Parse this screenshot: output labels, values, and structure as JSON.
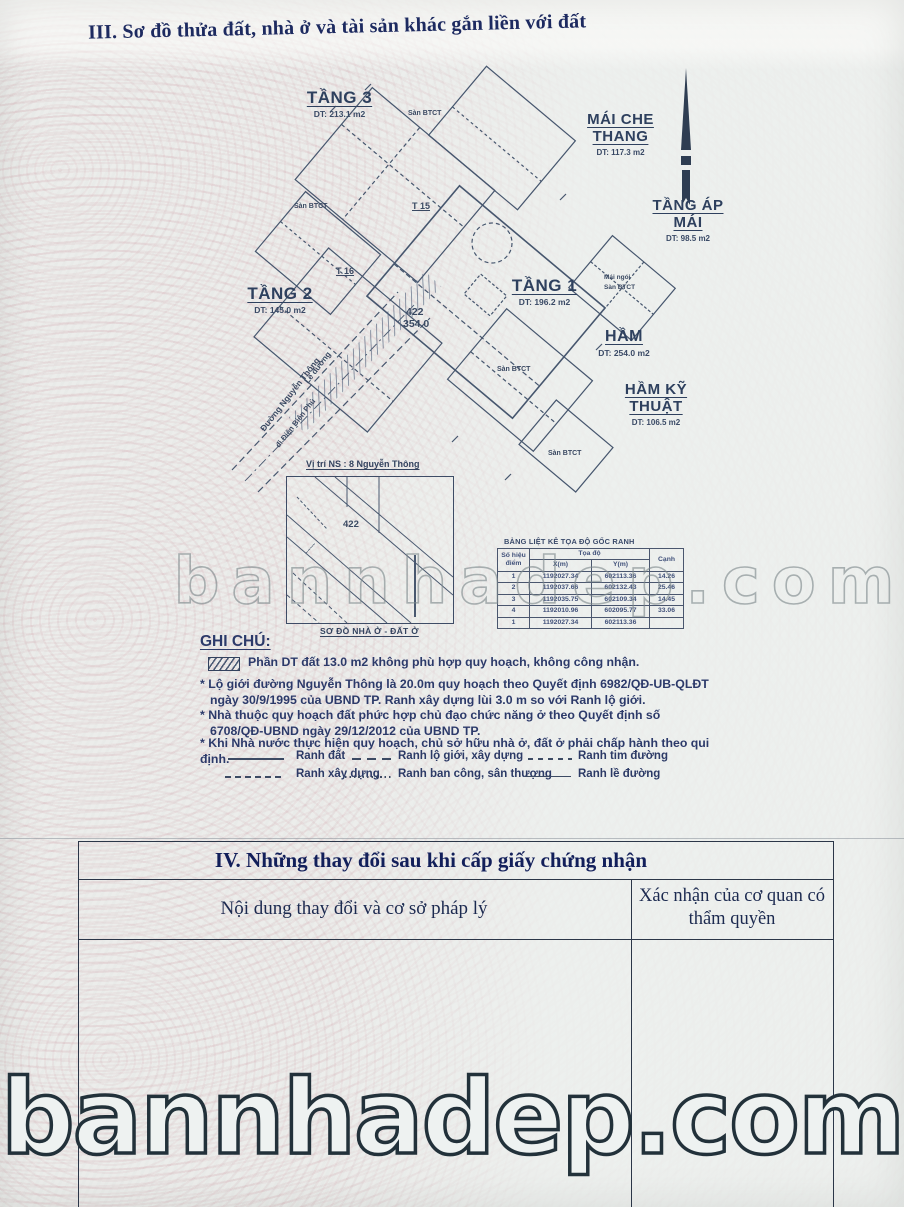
{
  "page": {
    "section3_title": "III. Sơ đồ thửa đất, nhà ở và tài sản khác gắn liền với đất",
    "watermark_middle": "bannhadep.com",
    "watermark_bottom": "bannhadep.com"
  },
  "plan": {
    "floors": [
      {
        "name": "TẦNG 3",
        "area": "DT: 213.1 m2"
      },
      {
        "name": "MÁI CHE THANG",
        "area": "DT: 117.3 m2"
      },
      {
        "name": "TẦNG ÁP MÁI",
        "area": "DT: 98.5 m2"
      },
      {
        "name": "TẦNG 2",
        "area": "DT: 145.0 m2"
      },
      {
        "name": "TẦNG 1",
        "area": "DT: 196.2 m2"
      },
      {
        "name": "HẦM",
        "area": "DT: 254.0 m2"
      },
      {
        "name": "HẦM KỸ THUẬT",
        "area": "DT: 106.5 m2"
      }
    ],
    "annotations": {
      "san_btct": "Sàn BTCT",
      "mai_ngoi": "Mái ngói",
      "t15": "T 15",
      "t16": "T 16",
      "parcel_number": "422",
      "parcel_area": "354.0",
      "le_duong": "Lề đường",
      "street_name": "Đường Nguyễn Thông",
      "street_direction": "đi Điện Biên Phủ"
    }
  },
  "location_map": {
    "caption": "Vị trí NS : 8 Nguyễn Thông",
    "parcel_number": "422",
    "title_below": "SƠ ĐỒ NHÀ Ở - ĐẤT Ở"
  },
  "coord_table": {
    "title": "BẢNG LIỆT KÊ TỌA ĐỘ GỐC RANH",
    "headers": {
      "point": "Số hiệu điểm",
      "coords": "Tọa độ",
      "x": "X(m)",
      "y": "Y(m)",
      "edge": "Cạnh"
    },
    "rows": [
      {
        "p": "1",
        "x": "1192027.34",
        "y": "602113.36",
        "c": "14.26"
      },
      {
        "p": "2",
        "x": "1192037.66",
        "y": "602132.43",
        "c": "25.46"
      },
      {
        "p": "3",
        "x": "1192035.75",
        "y": "602109.34",
        "c": "14.45"
      },
      {
        "p": "4",
        "x": "1192010.96",
        "y": "602095.77",
        "c": "33.06"
      },
      {
        "p": "1",
        "x": "1192027.34",
        "y": "602113.36",
        "c": ""
      }
    ]
  },
  "notes": {
    "heading": "GHI CHÚ:",
    "hatched_note": "Phần DT đất 13.0 m2 không phù hợp quy hoạch, không công nhận.",
    "items": [
      "* Lộ giới đường Nguyễn Thông là 20.0m quy hoạch theo Quyết định 6982/QĐ-UB-QLĐT ngày 30/9/1995 của UBND TP. Ranh xây dựng lùi 3.0 m so với Ranh lộ giới.",
      "* Nhà thuộc quy hoạch đất phức hợp chủ đạo chức năng ở theo Quyết định số 6708/QĐ-UBND ngày 29/12/2012 của UBND TP.",
      "* Khi Nhà nước thực hiện quy hoạch, chủ sở hữu nhà ở, đất ở phải chấp hành theo qui định."
    ]
  },
  "legend": {
    "items": [
      {
        "label": "Ranh đất"
      },
      {
        "label": "Ranh lộ giới, xây dựng"
      },
      {
        "label": "Ranh tim đường"
      },
      {
        "label": "Ranh xây dựng"
      },
      {
        "label": "Ranh ban công, sân thượng"
      },
      {
        "label": "Ranh lề đường"
      }
    ]
  },
  "section4": {
    "title": "IV. Những thay đổi sau khi cấp giấy chứng nhận",
    "col_content": "Nội dung thay đổi và cơ sở pháp lý",
    "col_confirm": "Xác nhận của cơ quan có thẩm quyền"
  }
}
